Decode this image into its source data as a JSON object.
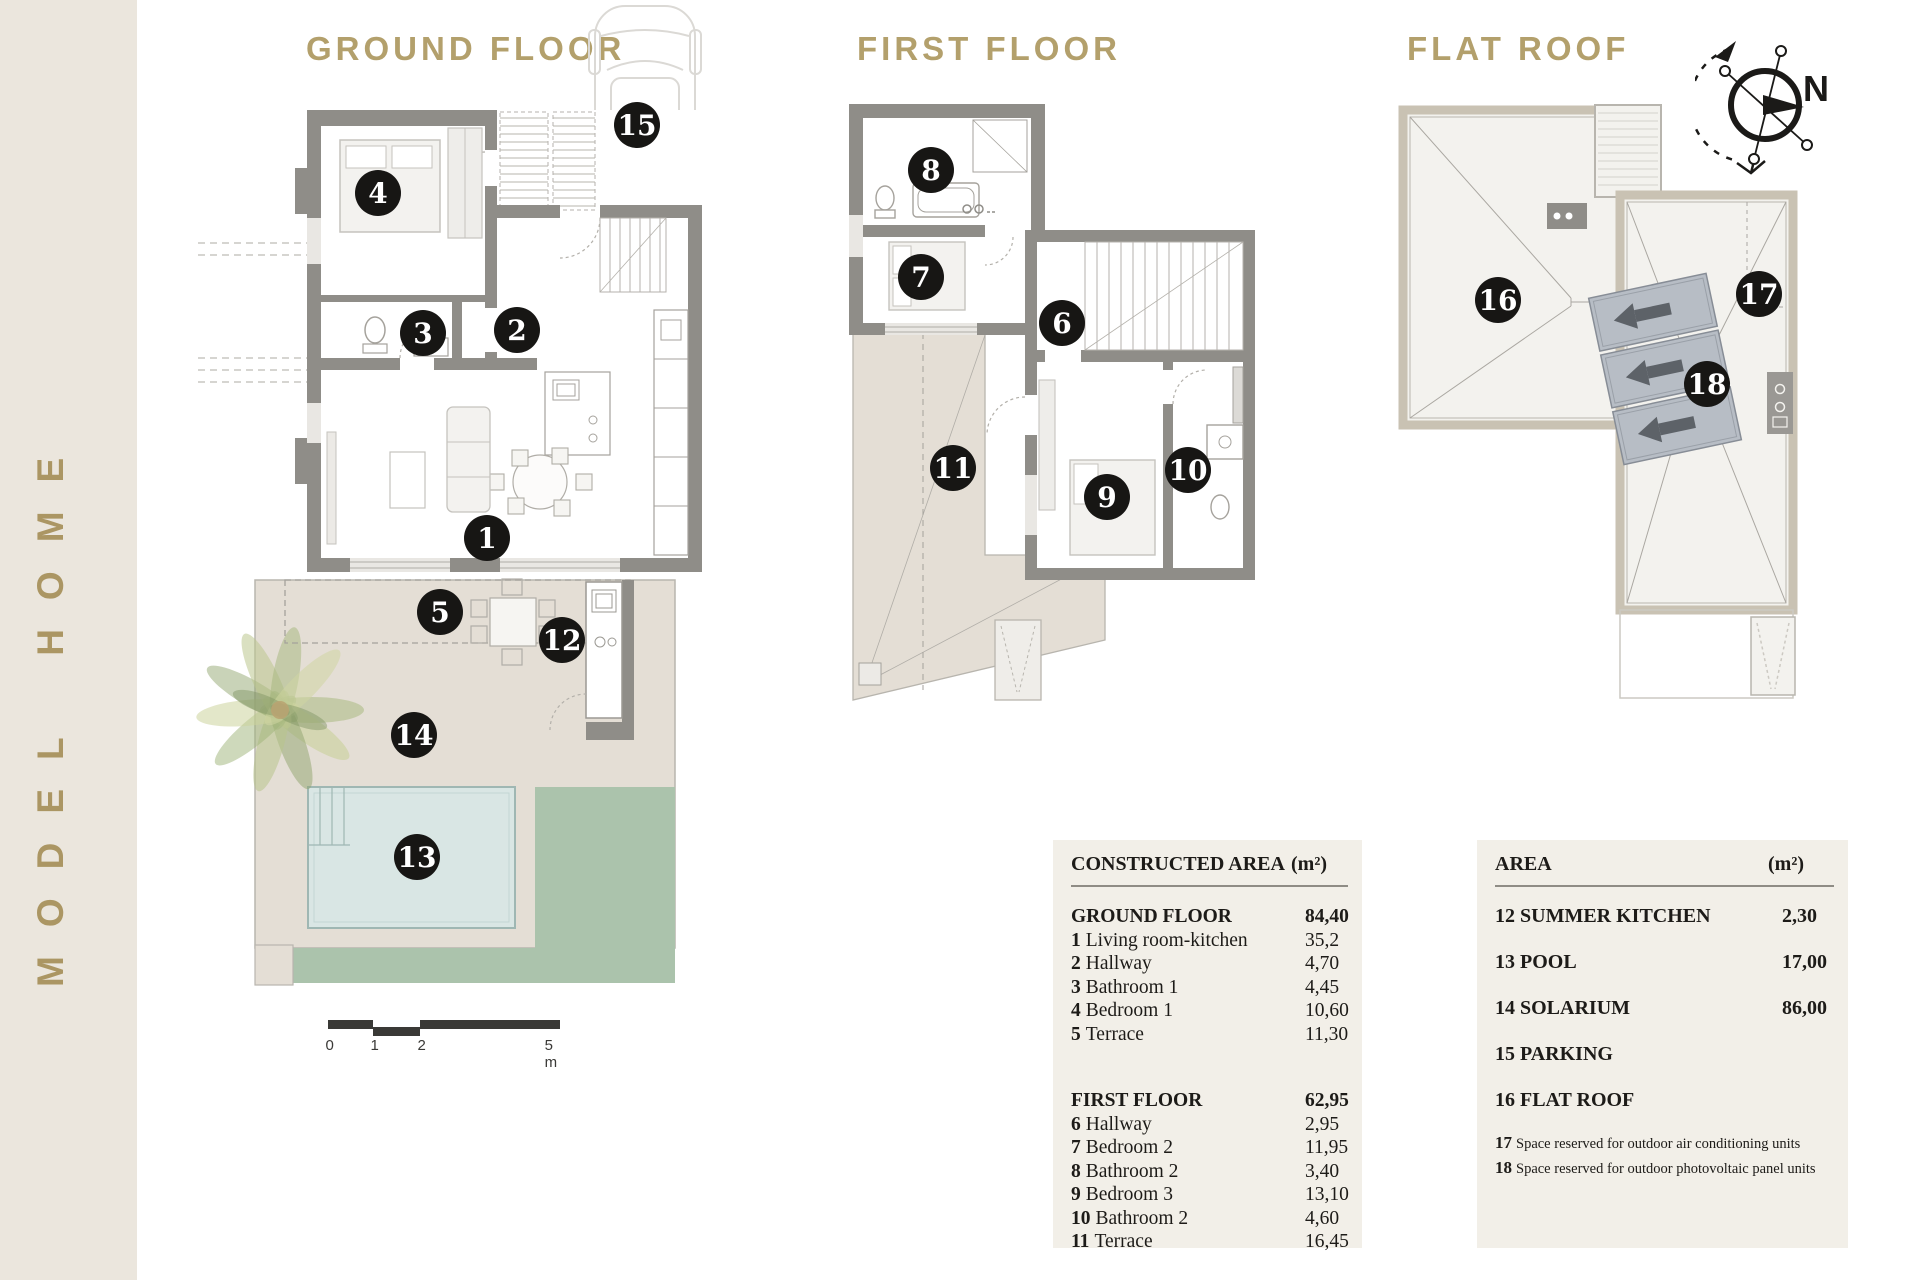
{
  "brand": "MODEL HOME",
  "sections": {
    "ground": "GROUND FLOOR",
    "first": "FIRST FLOOR",
    "roof": "FLAT ROOF"
  },
  "compass": {
    "north_label": "N"
  },
  "scale": {
    "labels": [
      {
        "t": "0",
        "x": 0
      },
      {
        "t": "1",
        "x": 45
      },
      {
        "t": "2",
        "x": 92
      },
      {
        "t": "5 m",
        "x": 222
      }
    ]
  },
  "markers": [
    {
      "n": "1",
      "x": 487,
      "y": 538
    },
    {
      "n": "2",
      "x": 517,
      "y": 330
    },
    {
      "n": "3",
      "x": 423,
      "y": 333
    },
    {
      "n": "4",
      "x": 378,
      "y": 193
    },
    {
      "n": "5",
      "x": 440,
      "y": 612
    },
    {
      "n": "12",
      "x": 562,
      "y": 640
    },
    {
      "n": "13",
      "x": 417,
      "y": 857
    },
    {
      "n": "14",
      "x": 414,
      "y": 735
    },
    {
      "n": "15",
      "x": 637,
      "y": 125
    },
    {
      "n": "6",
      "x": 1062,
      "y": 323
    },
    {
      "n": "7",
      "x": 921,
      "y": 277
    },
    {
      "n": "8",
      "x": 931,
      "y": 170
    },
    {
      "n": "9",
      "x": 1107,
      "y": 497
    },
    {
      "n": "10",
      "x": 1188,
      "y": 470
    },
    {
      "n": "11",
      "x": 953,
      "y": 468
    },
    {
      "n": "16",
      "x": 1498,
      "y": 300
    },
    {
      "n": "17",
      "x": 1759,
      "y": 294
    },
    {
      "n": "18",
      "x": 1707,
      "y": 384
    }
  ],
  "tables": {
    "constructed": {
      "header": "CONSTRUCTED AREA",
      "unit": "(m²)",
      "ground": {
        "title": "GROUND FLOOR",
        "total": "84,40",
        "rows": [
          {
            "n": "1",
            "label": "Living room-kitchen",
            "value": "35,2"
          },
          {
            "n": "2",
            "label": "Hallway",
            "value": "4,70"
          },
          {
            "n": "3",
            "label": "Bathroom 1",
            "value": "4,45"
          },
          {
            "n": "4",
            "label": "Bedroom 1",
            "value": "10,60"
          },
          {
            "n": "5",
            "label": "Terrace",
            "value": "11,30"
          }
        ]
      },
      "first": {
        "title": "FIRST FLOOR",
        "total": "62,95",
        "rows": [
          {
            "n": "6",
            "label": "Hallway",
            "value": "2,95"
          },
          {
            "n": "7",
            "label": "Bedroom 2",
            "value": "11,95"
          },
          {
            "n": "8",
            "label": "Bathroom 2",
            "value": "3,40"
          },
          {
            "n": "9",
            "label": "Bedroom 3",
            "value": "13,10"
          },
          {
            "n": "10",
            "label": "Bathroom 2",
            "value": "4,60"
          },
          {
            "n": "11",
            "label": "Terrace",
            "value": "16,45"
          }
        ]
      }
    },
    "area": {
      "header": "AREA",
      "unit": "(m²)",
      "rows": [
        {
          "n": "12",
          "label": "SUMMER KITCHEN",
          "value": "2,30"
        },
        {
          "n": "13",
          "label": "POOL",
          "value": "17,00"
        },
        {
          "n": "14",
          "label": "SOLARIUM",
          "value": "86,00"
        },
        {
          "n": "15",
          "label": "PARKING",
          "value": ""
        },
        {
          "n": "16",
          "label": "FLAT ROOF",
          "value": ""
        }
      ],
      "notes": [
        {
          "n": "17",
          "text": "Space reserved for outdoor air conditioning units"
        },
        {
          "n": "18",
          "text": "Space reserved for outdoor photovoltaic panel units"
        }
      ]
    }
  },
  "colors": {
    "accent_gold": "#b3a06c",
    "sidebar_bg": "#ebe6dd",
    "wall_gray": "#8f8d88",
    "terrace_beige": "#e4ded5",
    "pool_blue": "#d9e6e4",
    "lawn_green": "#abc3ac",
    "roof_fill": "#f3f2ee",
    "roof_border": "#c9c2b3",
    "solar_panel": "#b7bdc5",
    "marker_bg": "#171614",
    "table_bg": "#f2efe8"
  }
}
